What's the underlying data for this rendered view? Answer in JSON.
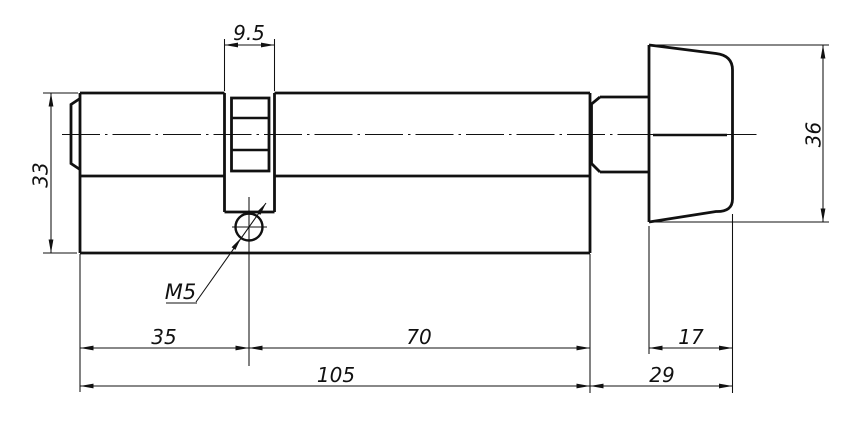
{
  "drawing": {
    "colors": {
      "background": "#ffffff",
      "line": "#111111"
    },
    "dimensions": {
      "cam_width": "9.5",
      "body_height": "33",
      "knob_height": "36",
      "segment_left": "35",
      "segment_right": "70",
      "knob_grip_depth": "17",
      "body_total_length": "105",
      "knob_total_depth": "29",
      "thread_callout": "M5"
    }
  }
}
